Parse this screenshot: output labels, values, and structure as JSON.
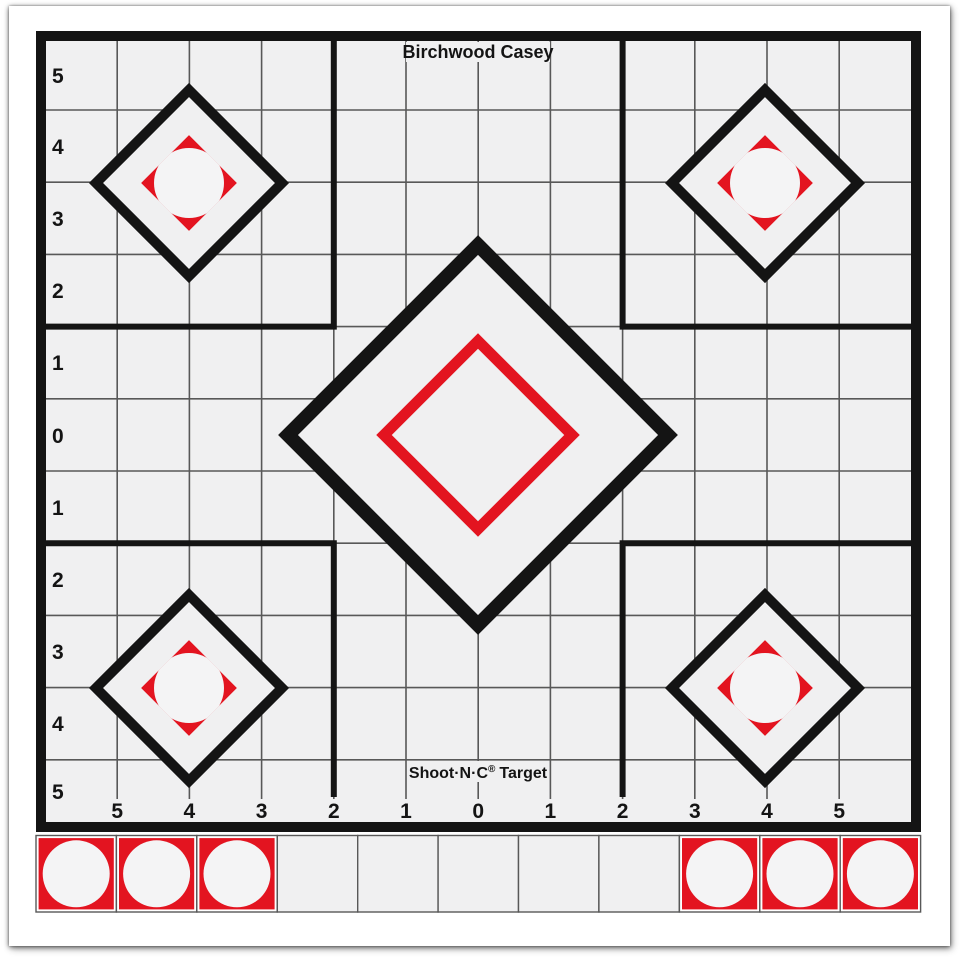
{
  "target": {
    "brand_top": "Birchwood Casey",
    "footer": {
      "name": "Shoot·N·C",
      "registered": "®",
      "word": "Target"
    },
    "colors": {
      "red": "#e31420",
      "ink": "#141414",
      "paper": "#f0f0f1",
      "grid_line": "#585858",
      "patch_white": "#f4f4f5"
    },
    "axes": {
      "left_labels": [
        "5",
        "4",
        "3",
        "2",
        "1",
        "0",
        "1",
        "2",
        "3",
        "4",
        "5"
      ],
      "bottom_labels": [
        "5",
        "4",
        "3",
        "2",
        "1",
        "0",
        "1",
        "2",
        "3",
        "4",
        "5"
      ]
    },
    "strip": {
      "cell_count": 11,
      "red_cell_indices": [
        0,
        1,
        2,
        8,
        9,
        10
      ]
    }
  }
}
